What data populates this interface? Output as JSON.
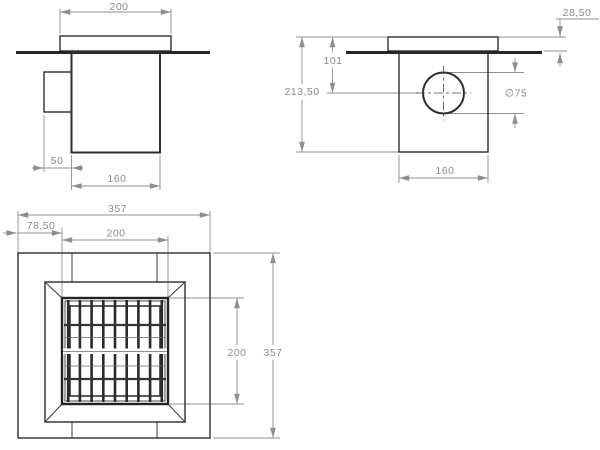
{
  "drawing": {
    "description": "Floor drain technical drawing, three orthographic views",
    "colors": {
      "feature_line": "#2e2e2e",
      "dimension_line": "#8f8f8f",
      "dimension_text": "#8a8a8a",
      "background": "#ffffff"
    },
    "side_view": {
      "cap_width": "200",
      "outlet_depth": "50",
      "body_width": "160"
    },
    "front_view": {
      "rim_height": "28,50",
      "outlet_center_depth": "101",
      "total_height": "213,50",
      "outlet_diameter": "∅75",
      "body_width": "160"
    },
    "top_view": {
      "overall_width": "357",
      "flange_offset": "78,50",
      "grate_width": "200",
      "grate_height": "200",
      "overall_height": "357"
    }
  }
}
